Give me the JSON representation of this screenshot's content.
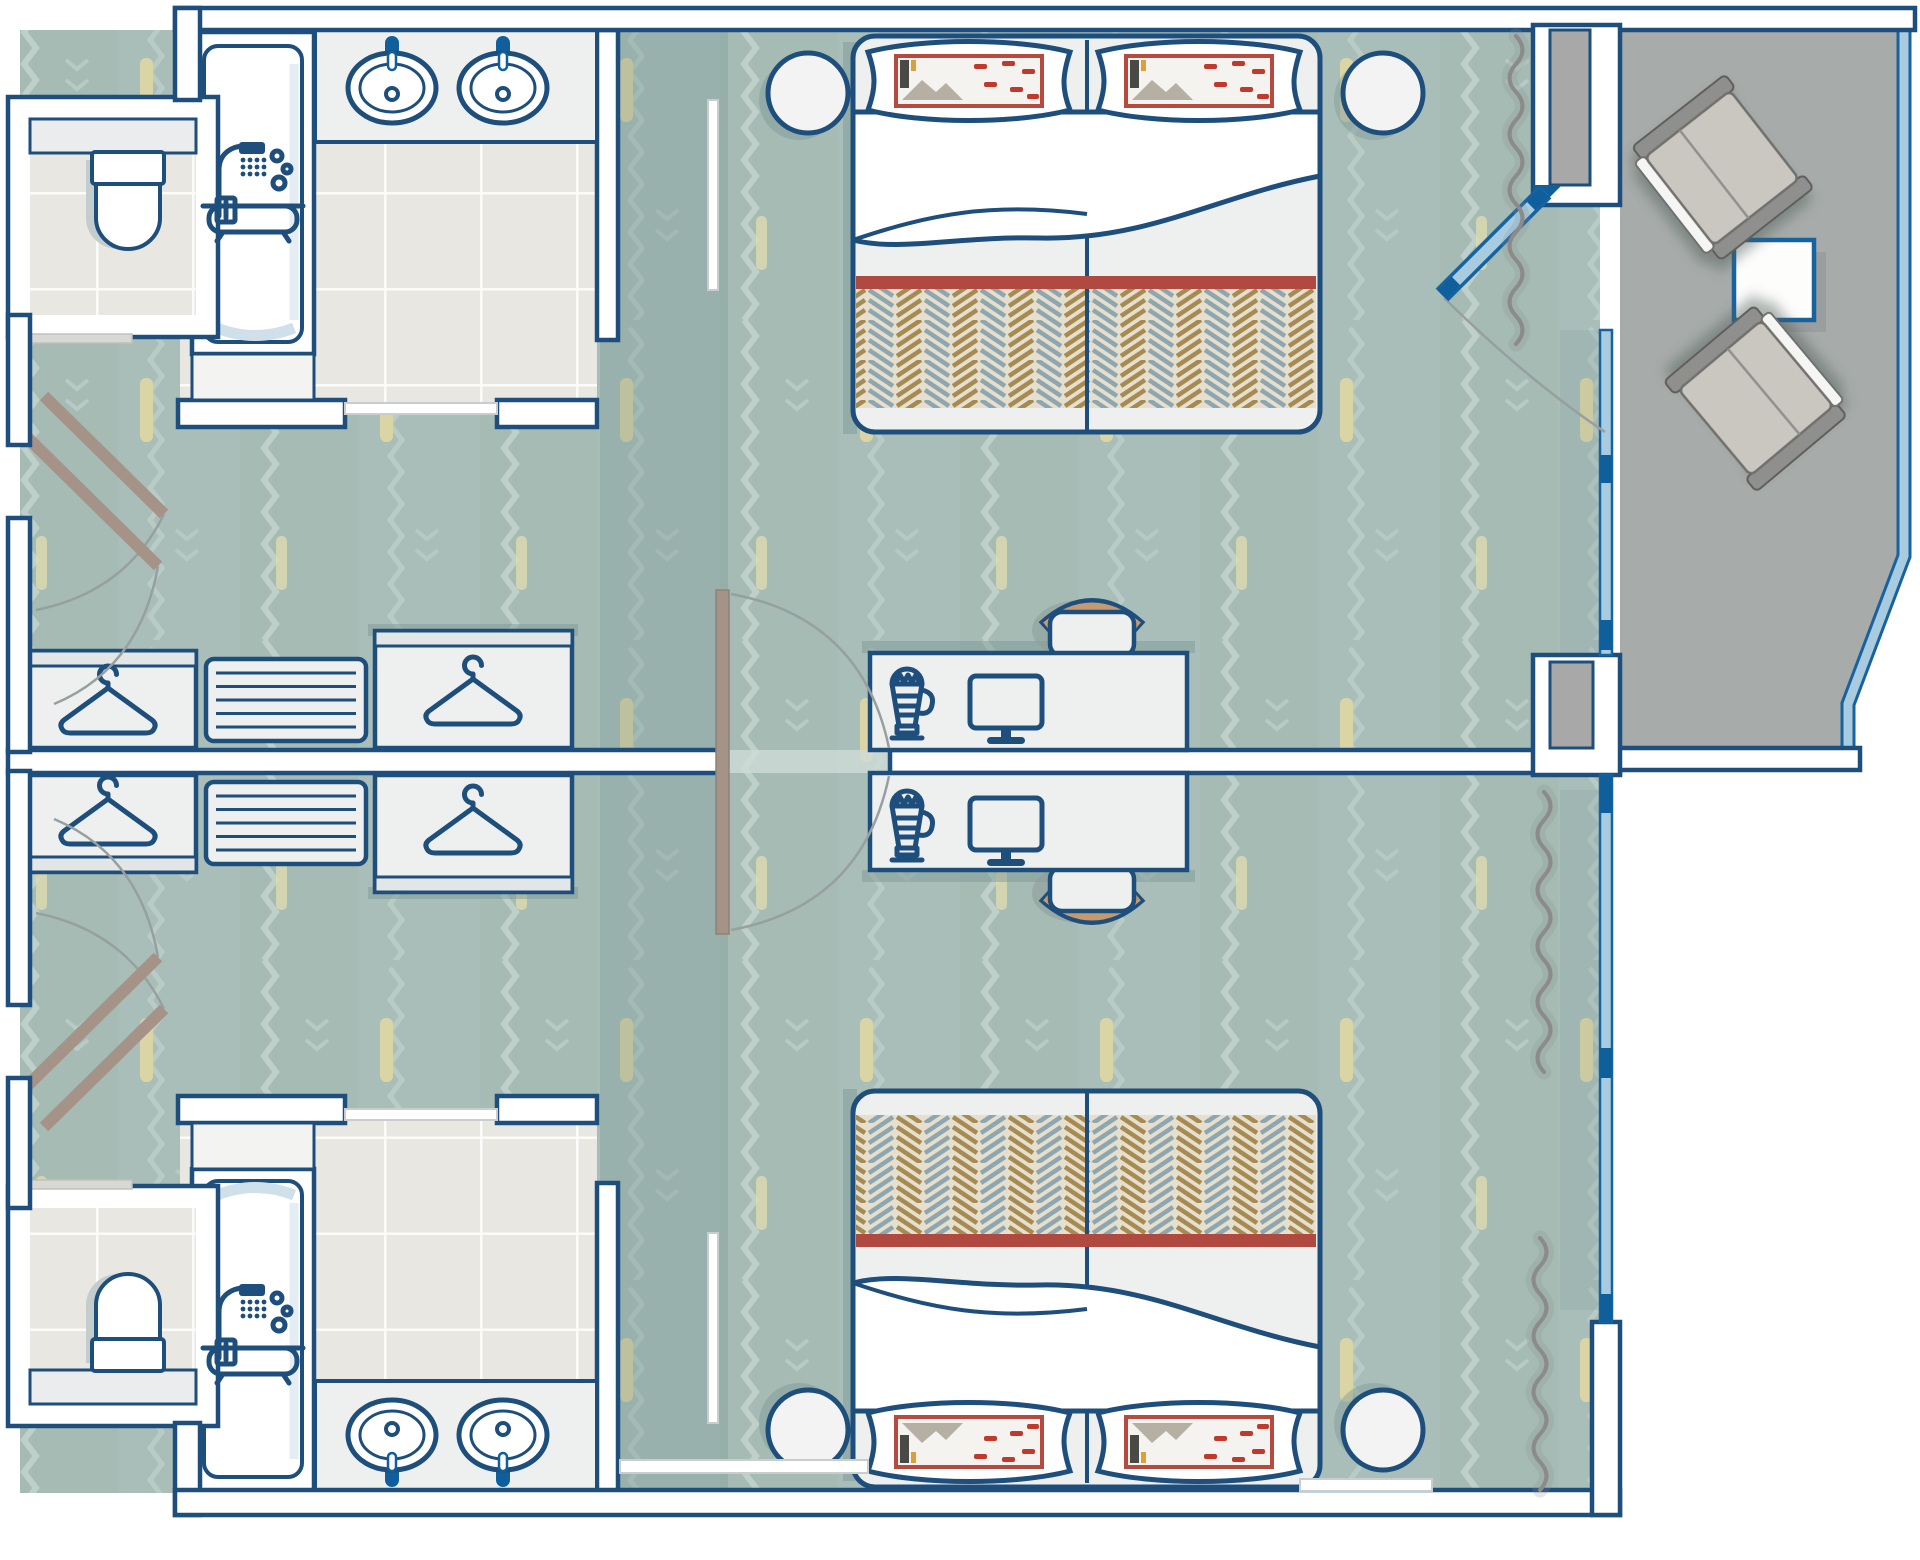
{
  "plan": {
    "type": "hotel-connecting-guest-rooms-floorplan",
    "orientation": "two rooms mirrored about a central dividing wall, balcony at top-right",
    "rooms": [
      {
        "id": "room-top",
        "carpet": "sage zigzag patterned carpet",
        "bed": {
          "kind": "double-bed",
          "pillows": 2,
          "blanket": "herringbone tan/blue with red stripe",
          "nightstands": 2
        },
        "wardrobes": 2,
        "drawer_unit_slats": 5,
        "desk": {
          "appliances": [
            "kettle",
            "tv"
          ],
          "chair": 1
        },
        "bathroom": {
          "sinks": 2,
          "bathtub_shower": 1,
          "toilet_room": 1,
          "floor": "beige tile"
        },
        "entry_doors": 2,
        "connecting_door": true,
        "balcony_access": true,
        "curtains": 1
      },
      {
        "id": "room-bottom",
        "carpet": "sage zigzag patterned carpet",
        "bed": {
          "kind": "double-bed",
          "pillows": 2,
          "blanket": "herringbone tan/blue with red stripe",
          "nightstands": 2
        },
        "wardrobes": 2,
        "drawer_unit_slats": 5,
        "desk": {
          "appliances": [
            "kettle",
            "tv"
          ],
          "chair": 1
        },
        "bathroom": {
          "sinks": 2,
          "bathtub_shower": 1,
          "toilet_room": 1,
          "floor": "beige tile"
        },
        "entry_doors": 2,
        "connecting_door": true,
        "balcony_access": false,
        "curtains": 2
      }
    ],
    "balcony": {
      "floor": "gray",
      "lounge_chairs": 2,
      "side_table": 1,
      "sliding_glass_door": 1,
      "railing": "light blue"
    }
  },
  "icons": [
    "hanger-icon",
    "shower-bath-icon",
    "kettle-icon",
    "tv-icon",
    "sink-icon",
    "toilet-icon"
  ],
  "labels": {
    "plan": "Floor plan of two connecting hotel guest rooms with balcony",
    "room_top": "Guest room (top)",
    "room_bottom": "Guest room (bottom)",
    "balcony": "Balcony with two lounge chairs and side table",
    "bathroom_top": "Bathroom with double vanity, tub and toilet room (top)",
    "bathroom_bottom": "Bathroom with double vanity, tub and toilet room (bottom)",
    "bed_top": "Double bed with two pillows (top room)",
    "bed_bottom": "Double bed with two pillows (bottom room)",
    "desk_top": "Desk with kettle and TV (top room)",
    "desk_bottom": "Desk with kettle and TV (bottom room)",
    "closets_top": "Wardrobes and drawer unit (top room)",
    "closets_bottom": "Wardrobes and drawer unit (bottom room)",
    "connecting_door": "Connecting door between rooms",
    "sliding_door": "Sliding glass door to balcony"
  },
  "colors": {
    "line": "#1e4e7c",
    "carpet": "#a9beb9",
    "carpet-band": "#a2b7b1",
    "carpet-zig": "#c8d7d2",
    "accent-yellow": "#ddd6a4",
    "tile": "#e9e7e1",
    "grout": "#fbfbf9",
    "furniture": "#eef0ef",
    "balcony-floor": "#a7aba9",
    "column-gray": "#a8a8a8",
    "glazing": "#a8cbe0",
    "glazing-line": "#17639f",
    "glazing-dark": "#0f5f9c",
    "red-stripe": "#b04a41",
    "pillow-red": "#b64a3e",
    "blanket-tan": "#a58a51",
    "blanket-blue": "#8ea6af",
    "blanket-base": "#e6dfcd",
    "door-leaf": "#a69387",
    "curtain": "#8b8b8b",
    "swing-arc": "#97a0a0",
    "shadow-teal": "#7f9a96",
    "chair-tan": "#c59a6f"
  }
}
